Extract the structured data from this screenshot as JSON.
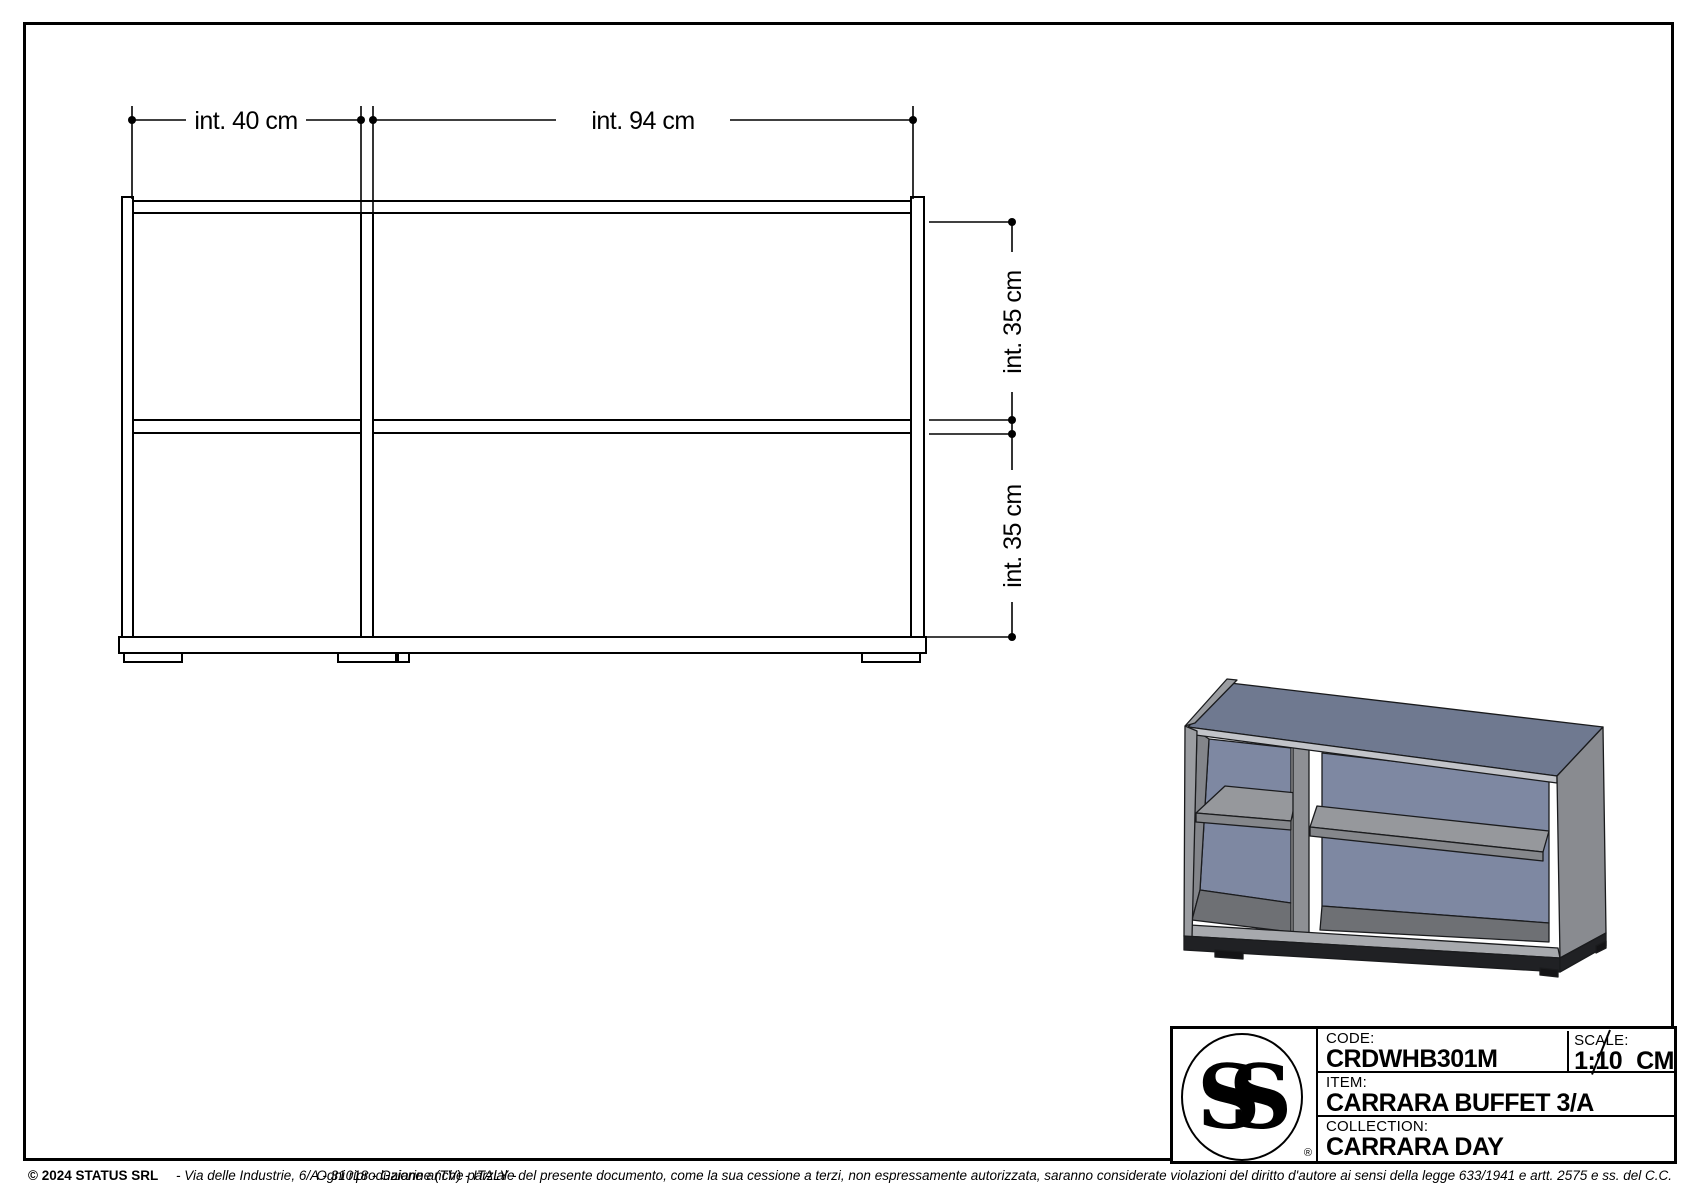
{
  "front_view": {
    "width_dims": [
      {
        "label": "int. 40 cm"
      },
      {
        "label": "int. 94 cm"
      }
    ],
    "height_dims": [
      {
        "label": "int. 35 cm"
      },
      {
        "label": "int. 35 cm"
      }
    ]
  },
  "render3d": {
    "colors": {
      "top_face": "#6f7990",
      "back_panel": "#7e88a2",
      "side_face": "#898b90",
      "left_edge": "#9b9da1",
      "inner_wall": "#83858a",
      "shelf_face": "#96989c",
      "shelf_edge": "#85878b",
      "divider_face": "#8e9094",
      "bottom_rail": "#a7a9ad",
      "top_front_edge": "#c2c4c9",
      "plinth": "#202124",
      "foot": "#141416",
      "outline": "#1a1b1d"
    }
  },
  "title_block": {
    "logo_text": "SS",
    "registered_mark": "®",
    "code_label": "CODE:",
    "code_value": "CRDWHB301M",
    "scale_label": "SCALE:",
    "scale_value": "1:10",
    "scale_unit": "CM",
    "item_label": "ITEM:",
    "item_value": "CARRARA BUFFET 3/A",
    "collection_label": "COLLECTION:",
    "collection_value": "CARRARA DAY"
  },
  "footer": {
    "copyright": "© 2024 STATUS SRL",
    "address": "-  Via delle Industrie, 6/A - 31018   -   Gaiarine (TV)   -   ITALY   -",
    "legal": "Ogni riproduzione anche parziale del presente documento, come la sua cessione a terzi, non espressamente autorizzata, saranno considerate violazioni del diritto d'autore ai sensi della legge 633/1941 e artt. 2575 e ss. del C.C."
  }
}
